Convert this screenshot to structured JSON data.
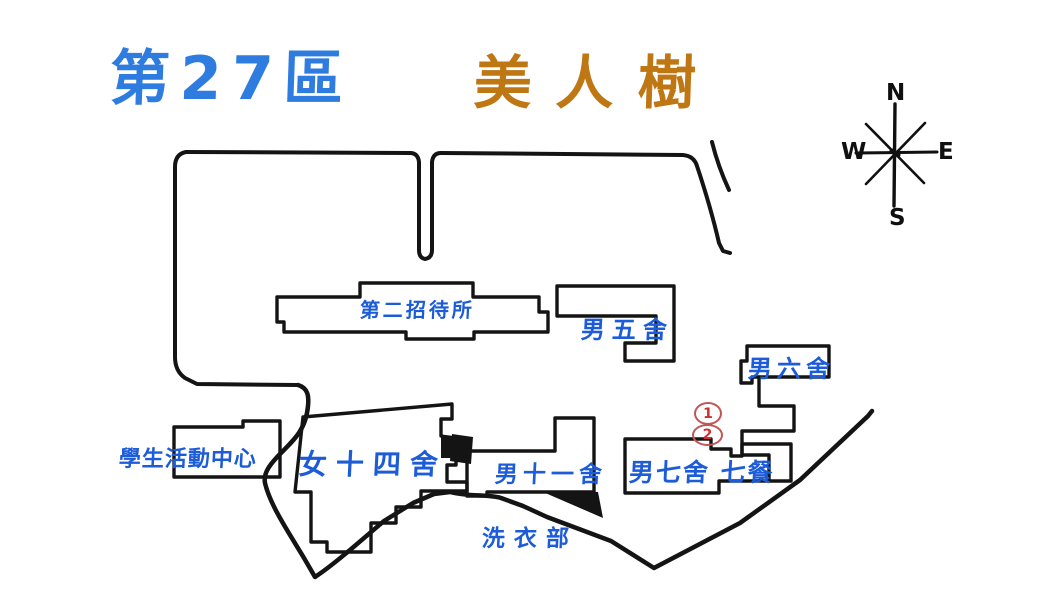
{
  "title": {
    "district": "第27區",
    "name": "美人樹"
  },
  "compass": {
    "n": "N",
    "e": "E",
    "s": "S",
    "w": "W"
  },
  "map": {
    "labels": [
      {
        "id": "second-guest-house",
        "text": "第二招待所"
      },
      {
        "id": "male-dorm-5",
        "text": "男五舍"
      },
      {
        "id": "male-dorm-6",
        "text": "男六舍"
      },
      {
        "id": "student-activity-center",
        "text": "學生活動中心"
      },
      {
        "id": "female-dorm-14",
        "text": "女十四舍"
      },
      {
        "id": "male-dorm-11",
        "text": "男十一舍"
      },
      {
        "id": "male-dorm-7-cafeteria-7",
        "text": "男七舍 七餐"
      },
      {
        "id": "laundry-dept",
        "text": "洗衣部"
      }
    ],
    "markers": [
      {
        "id": "marker-1",
        "label": "1"
      },
      {
        "id": "marker-2",
        "label": "2"
      }
    ]
  },
  "colors": {
    "label_blue": "#1c5cd8",
    "title_blue": "#2e7ce0",
    "title_orange": "#bf7714",
    "marker_red": "#c25555",
    "line_black": "#141414"
  }
}
